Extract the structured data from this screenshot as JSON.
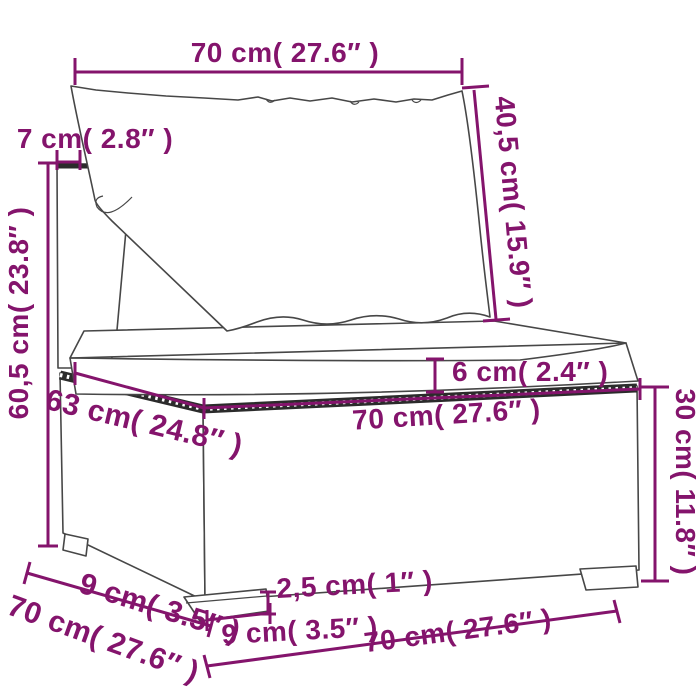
{
  "diagram": {
    "title_hint": "poly rattan sofa section dimension drawing",
    "accent_color": "#84146c",
    "line_art_color": "#474747",
    "background_color": "#ffffff",
    "labels": {
      "top_width": "70 cm( 27.6″ )",
      "backrest_thickness": "7 cm( 2.8″ )",
      "back_cushion_height": "40,5 cm( 15.9″ )",
      "total_height": "60,5 cm( 23.8″ )",
      "seat_cushion_thickness": "6 cm( 2.4″ )",
      "seat_width": "70 cm( 27.6″ )",
      "seat_depth": "63 cm( 24.8″ )",
      "base_height": "30 cm( 11.8″ )",
      "foot_height": "2,5 cm( 1″ )",
      "foot_width_front": "9 cm( 3.5″ )",
      "foot_depth_side": "9 cm( 3.5″ )",
      "side_depth": "70 cm( 27.6″ )",
      "bottom_width": "70 cm( 27.6″ )"
    }
  }
}
